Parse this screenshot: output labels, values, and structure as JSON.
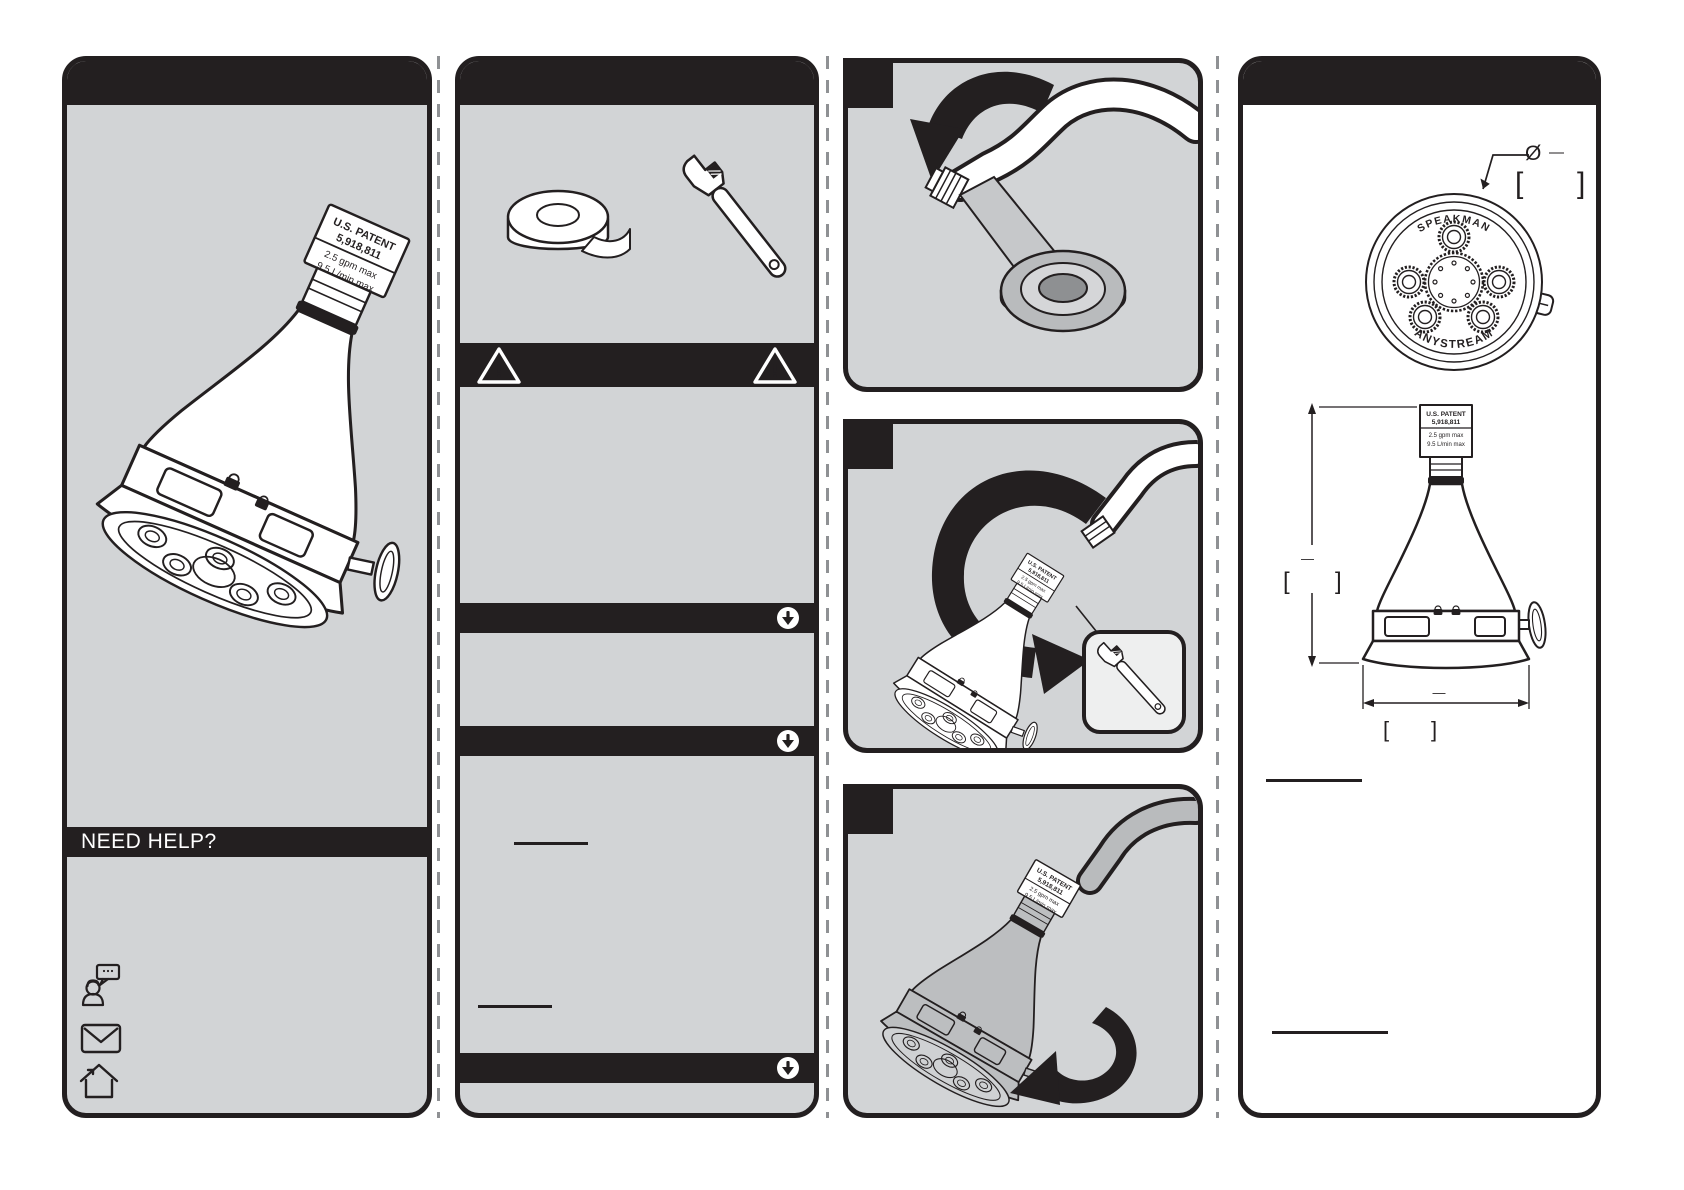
{
  "sheet": {
    "background": "#ffffff",
    "ink_color": "#231f20",
    "panel_color": "#d2d4d6"
  },
  "panel_product": {
    "need_help_label": "NEED HELP?",
    "icons": {
      "chat": "chat-support-icon",
      "email": "email-icon",
      "home": "home-icon"
    }
  },
  "product_label": {
    "line1": "U.S. PATENT",
    "line2": "5,918,811",
    "line3": "2.5 gpm max",
    "line4": "9.5 L/min max"
  },
  "panel_tools": {
    "icons": {
      "tape": "teflon-tape-icon",
      "wrench": "adjustable-wrench-icon",
      "warning": "warning-triangle-icon",
      "section_arrow": "down-arrow-circle-icon"
    },
    "warning_mark": "!"
  },
  "steps": {
    "icons": {
      "badge": "step-number-badge",
      "rotate_arrow": "rotation-arrow-icon"
    }
  },
  "panel_specs": {
    "face_view": {
      "brand_top": "SPEAKMAN",
      "brand_bottom": "ANYSTREAM",
      "diameter_symbol": "Ø",
      "dim_dash": "—",
      "bracket_open": "[",
      "bracket_close": "]"
    },
    "side_view": {
      "dim_dash": "—",
      "bracket_open": "[",
      "bracket_close": "]"
    }
  }
}
